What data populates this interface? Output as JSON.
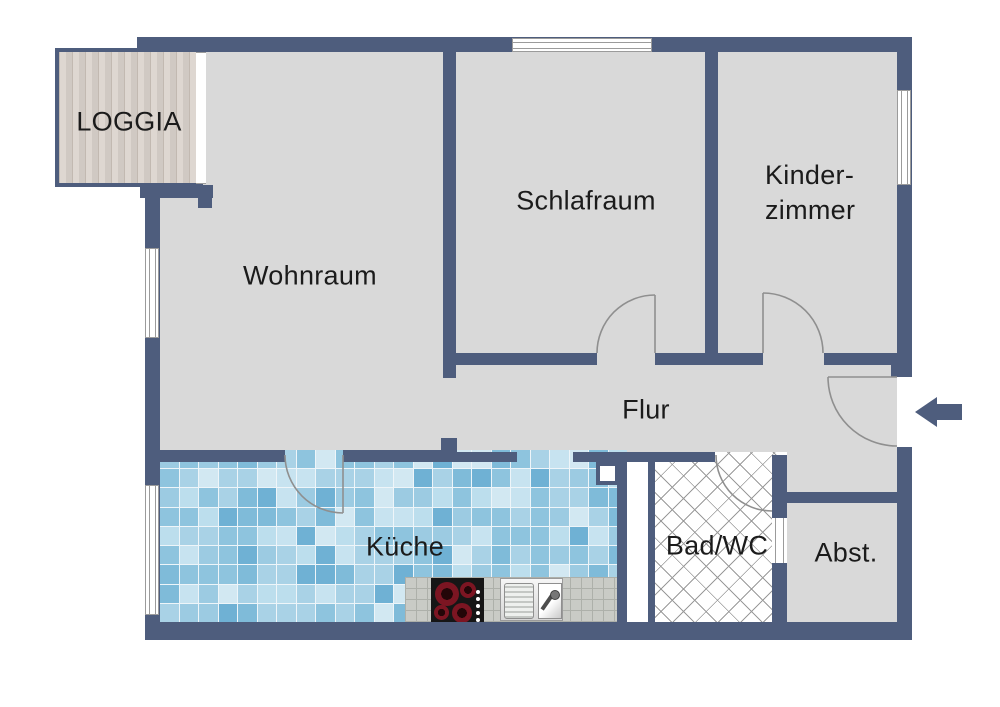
{
  "title": "Apartment floor plan",
  "rooms": {
    "loggia": {
      "label": "LOGGIA"
    },
    "wohnraum": {
      "label": "Wohnraum"
    },
    "schlafraum": {
      "label": "Schlafraum"
    },
    "kinderzimmer": {
      "lines": [
        "Kinder-",
        "zimmer"
      ]
    },
    "flur": {
      "label": "Flur"
    },
    "kueche": {
      "label": "Küche"
    },
    "badwc": {
      "label": "Bad/WC"
    },
    "abstellraum": {
      "label": "Abst."
    }
  },
  "icons": {
    "entrance_arrow": "arrow-left-icon",
    "stove": "cooktop-icon",
    "sink": "kitchen-sink-icon"
  },
  "colors": {
    "wall": "#4e5d7d",
    "floor": "#d9d9d9",
    "text": "#1b1b1b",
    "door-line": "#8f8f8f",
    "window-line": "#9b9b9b",
    "wood-light": "#ded7d1",
    "wood-dark": "#c2b9b1",
    "grout": "#eef5f9",
    "hatch-line": "#9a9a9a",
    "counter": "#c9cbc6",
    "counter-line": "#adb0aa",
    "stove": "#161616",
    "burner": "#7c1522",
    "burner-dark": "#230608"
  },
  "tile_palette": [
    "#d2e8f2",
    "#a9d2e6",
    "#8ec4de",
    "#6fb1d4",
    "#bcdeed",
    "#9ccbe2",
    "#7fbbd9",
    "#c7e3f0",
    "#a9d2e6",
    "#8ec4de"
  ]
}
